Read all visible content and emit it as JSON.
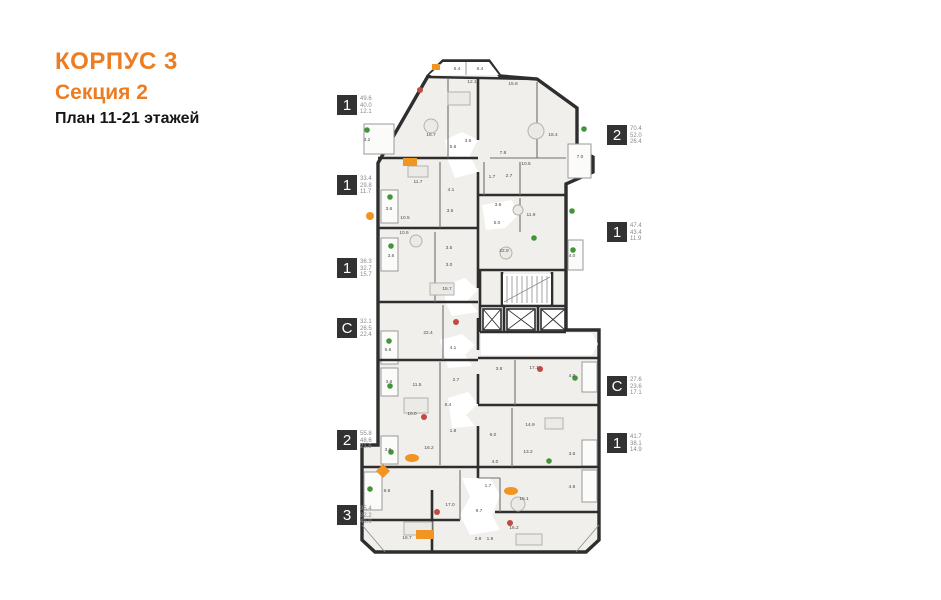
{
  "title": {
    "building": "КОРПУС 3",
    "section": "Секция 2",
    "plan": "План 11-21 этажей"
  },
  "colors": {
    "accent_orange": "#ed7d22",
    "badge_bg": "#323232",
    "wall": "#2e2e2e",
    "room_fill": "#f0efec",
    "plant_green": "#43953b",
    "furniture_orange": "#f29422",
    "accent_red": "#c24a42"
  },
  "legend_left": [
    {
      "type": "1",
      "areas": [
        "49.6",
        "40.0",
        "12.1"
      ]
    },
    {
      "type": "1",
      "areas": [
        "33.4",
        "29.8",
        "11.7"
      ]
    },
    {
      "type": "1",
      "areas": [
        "36.3",
        "32.7",
        "15.7"
      ]
    },
    {
      "type": "С",
      "areas": [
        "32.1",
        "26.5",
        "22.4"
      ]
    },
    {
      "type": "2",
      "areas": [
        "55.8",
        "48.6",
        "21.5"
      ]
    },
    {
      "type": "3",
      "areas": [
        "95.4",
        "82.2",
        "49.9"
      ]
    }
  ],
  "legend_right": [
    {
      "type": "2",
      "areas": [
        "70.4",
        "52.0",
        "26.4"
      ]
    },
    {
      "type": "1",
      "areas": [
        "47.4",
        "43.4",
        "11.9"
      ]
    },
    {
      "type": "С",
      "areas": [
        "27.6",
        "23.6",
        "17.1"
      ]
    },
    {
      "type": "1",
      "areas": [
        "41.7",
        "38.1",
        "14.9"
      ]
    }
  ],
  "plan": {
    "room_labels": [
      {
        "x": 457,
        "y": 70,
        "v": "6.4"
      },
      {
        "x": 480,
        "y": 70,
        "v": "6.4"
      },
      {
        "x": 472,
        "y": 83,
        "v": "12.1"
      },
      {
        "x": 513,
        "y": 85,
        "v": "15.8"
      },
      {
        "x": 431,
        "y": 136,
        "v": "18.7"
      },
      {
        "x": 367,
        "y": 141,
        "v": "3.2"
      },
      {
        "x": 453,
        "y": 148,
        "v": "5.6"
      },
      {
        "x": 468,
        "y": 142,
        "v": "3.6"
      },
      {
        "x": 553,
        "y": 136,
        "v": "18.4"
      },
      {
        "x": 503,
        "y": 154,
        "v": "7.8"
      },
      {
        "x": 526,
        "y": 165,
        "v": "10.6"
      },
      {
        "x": 580,
        "y": 158,
        "v": "7.0"
      },
      {
        "x": 492,
        "y": 178,
        "v": "1.7"
      },
      {
        "x": 509,
        "y": 177,
        "v": "2.7"
      },
      {
        "x": 418,
        "y": 183,
        "v": "11.7"
      },
      {
        "x": 451,
        "y": 191,
        "v": "4.1"
      },
      {
        "x": 389,
        "y": 210,
        "v": "3.6"
      },
      {
        "x": 405,
        "y": 219,
        "v": "10.5"
      },
      {
        "x": 450,
        "y": 212,
        "v": "3.5"
      },
      {
        "x": 498,
        "y": 206,
        "v": "3.6"
      },
      {
        "x": 531,
        "y": 216,
        "v": "11.9"
      },
      {
        "x": 497,
        "y": 224,
        "v": "5.0"
      },
      {
        "x": 404,
        "y": 234,
        "v": "10.5"
      },
      {
        "x": 449,
        "y": 249,
        "v": "3.5"
      },
      {
        "x": 391,
        "y": 257,
        "v": "3.6"
      },
      {
        "x": 449,
        "y": 266,
        "v": "3.0"
      },
      {
        "x": 504,
        "y": 252,
        "v": "22.9"
      },
      {
        "x": 572,
        "y": 257,
        "v": "4.0"
      },
      {
        "x": 447,
        "y": 290,
        "v": "15.7"
      },
      {
        "x": 428,
        "y": 334,
        "v": "22.4"
      },
      {
        "x": 388,
        "y": 351,
        "v": "5.6"
      },
      {
        "x": 453,
        "y": 349,
        "v": "4.1"
      },
      {
        "x": 417,
        "y": 386,
        "v": "11.5"
      },
      {
        "x": 456,
        "y": 381,
        "v": "2.7"
      },
      {
        "x": 389,
        "y": 383,
        "v": "3.6"
      },
      {
        "x": 499,
        "y": 370,
        "v": "3.8"
      },
      {
        "x": 534,
        "y": 369,
        "v": "17.1"
      },
      {
        "x": 572,
        "y": 377,
        "v": "4.0"
      },
      {
        "x": 412,
        "y": 415,
        "v": "10.0"
      },
      {
        "x": 448,
        "y": 406,
        "v": "6.4"
      },
      {
        "x": 453,
        "y": 432,
        "v": "1.8"
      },
      {
        "x": 493,
        "y": 436,
        "v": "6.0"
      },
      {
        "x": 530,
        "y": 426,
        "v": "14.9"
      },
      {
        "x": 429,
        "y": 449,
        "v": "16.2"
      },
      {
        "x": 388,
        "y": 451,
        "v": "3.6"
      },
      {
        "x": 528,
        "y": 453,
        "v": "13.2"
      },
      {
        "x": 495,
        "y": 463,
        "v": "4.0"
      },
      {
        "x": 572,
        "y": 455,
        "v": "3.6"
      },
      {
        "x": 387,
        "y": 492,
        "v": "6.6"
      },
      {
        "x": 488,
        "y": 487,
        "v": "1.7"
      },
      {
        "x": 572,
        "y": 488,
        "v": "4.6"
      },
      {
        "x": 450,
        "y": 506,
        "v": "17.0"
      },
      {
        "x": 479,
        "y": 512,
        "v": "9.7"
      },
      {
        "x": 524,
        "y": 500,
        "v": "16.1"
      },
      {
        "x": 407,
        "y": 539,
        "v": "16.7"
      },
      {
        "x": 478,
        "y": 540,
        "v": "2.9"
      },
      {
        "x": 490,
        "y": 540,
        "v": "1.9"
      },
      {
        "x": 514,
        "y": 529,
        "v": "16.2"
      }
    ]
  }
}
